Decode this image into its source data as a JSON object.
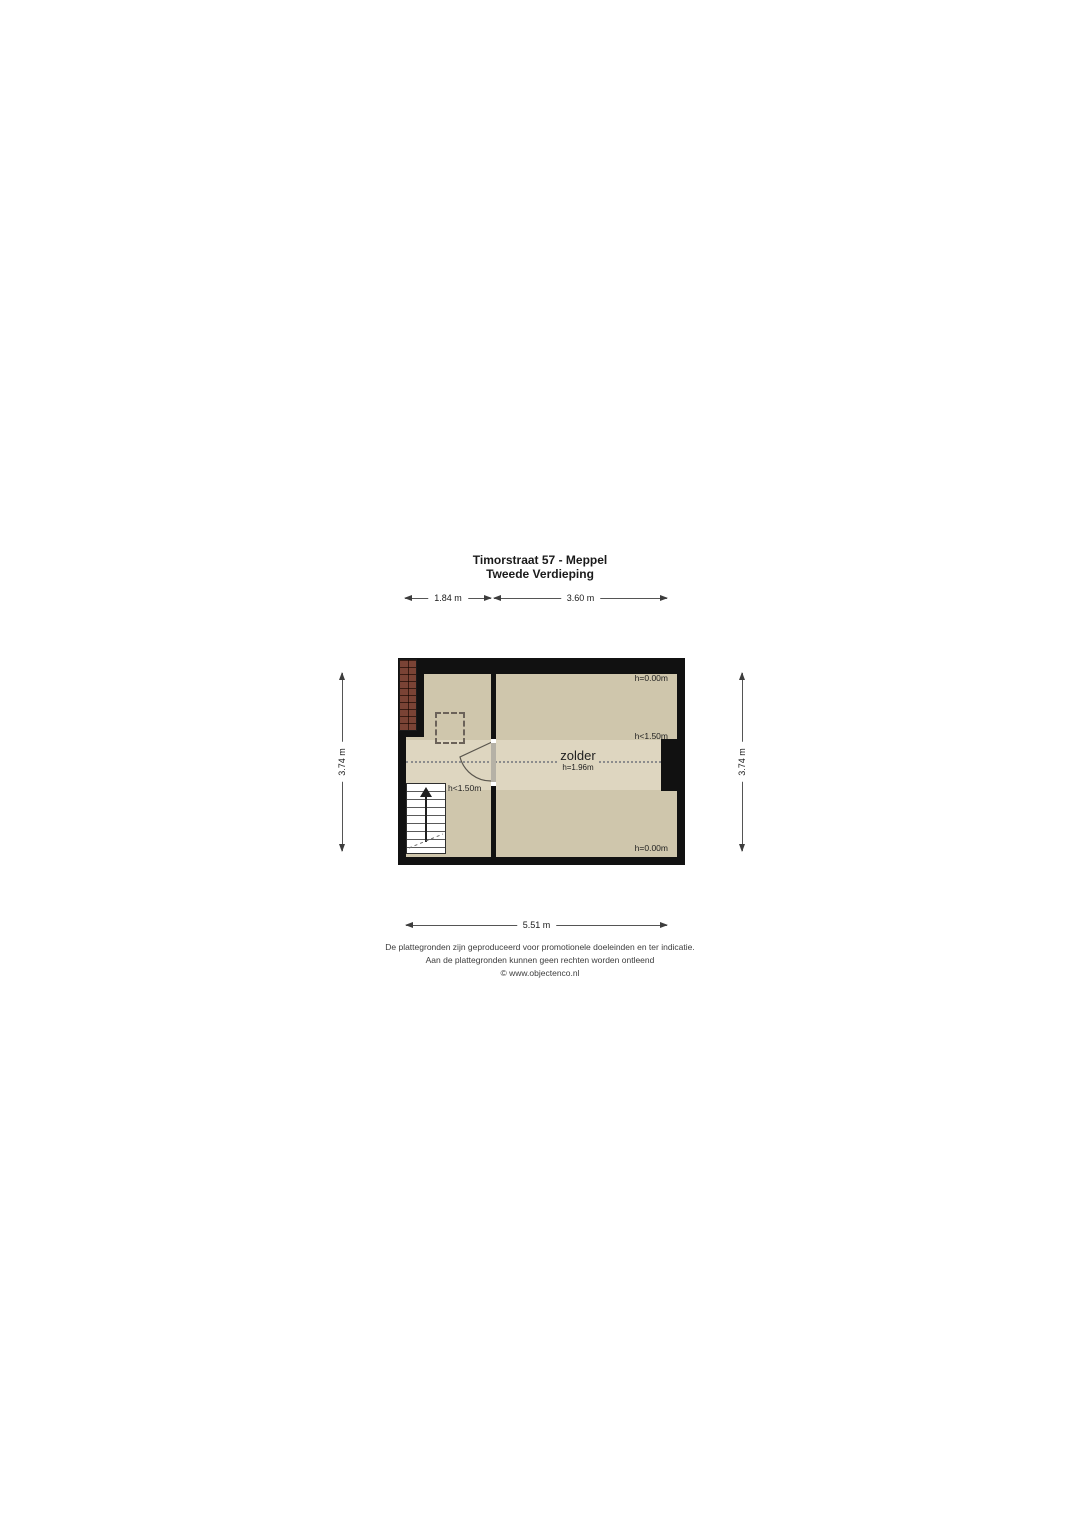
{
  "page": {
    "title_line1": "Timorstraat 57 - Meppel",
    "title_line2": "Tweede Verdieping"
  },
  "dimensions": {
    "top_segment1": "1.84 m",
    "top_segment2": "3.60 m",
    "side_left": "3.74 m",
    "side_right": "3.74 m",
    "bottom": "5.51 m"
  },
  "floorplan": {
    "room": {
      "name": "zolder",
      "height": "h=1.96m"
    },
    "height_annotations": {
      "top_right": "h=0.00m",
      "mid_right": "h<1.50m",
      "mid_left": "h<1.50m",
      "bottom_right": "h=0.00m"
    },
    "colors": {
      "wall": "#111111",
      "floor": "#cfc6ac",
      "floor_light_band": "#ded6c0",
      "roof_tiles": "#7a4335",
      "door": "#b5b1a6",
      "dotted_line": "#8c8c8c"
    }
  },
  "footer": {
    "line1": "De plattegronden zijn geproduceerd voor promotionele doeleinden en ter indicatie.",
    "line2": "Aan de plattegronden kunnen geen rechten worden ontleend",
    "line3": "© www.objectenco.nl"
  }
}
